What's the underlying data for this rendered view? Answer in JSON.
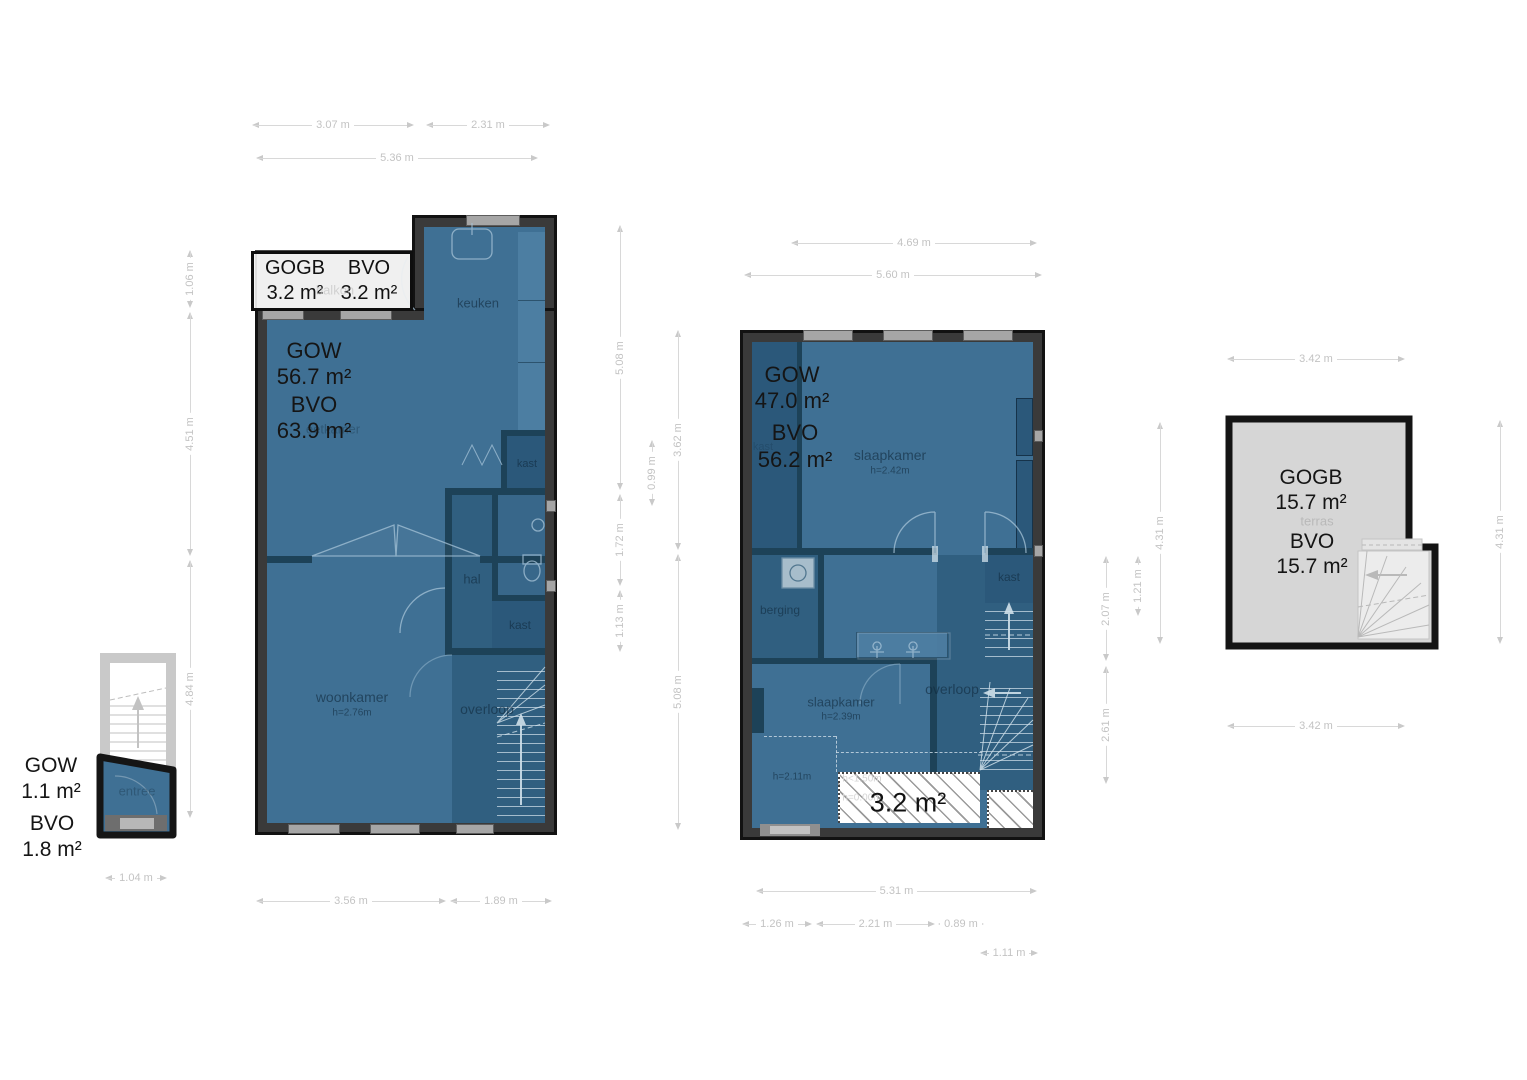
{
  "plans": {
    "floor1": {
      "balkon_box": {
        "col1_title": "GOGB",
        "col1_value": "3.2 m²",
        "col2_title": "BVO",
        "col2_value": "3.2 m²"
      },
      "gow_label": "GOW",
      "gow_value": "56.7 m²",
      "bvo_label": "BVO",
      "bvo_value": "63.9 m²",
      "rooms": {
        "balkon": "balkon",
        "keuken": "keuken",
        "eetkamer": "eetkamer",
        "hal": "hal",
        "kast_a": "kast",
        "kast_b": "kast",
        "woonkamer": "woonkamer",
        "woonkamer_height": "h=2.76m",
        "overloop": "overloop"
      }
    },
    "floor2": {
      "gow_label": "GOW",
      "gow_value": "47.0 m²",
      "bvo_label": "BVO",
      "bvo_value": "56.2 m²",
      "rooms": {
        "kast_left": "kast",
        "slaapkamer1": "slaapkamer",
        "slaapkamer1_height": "h=2.42m",
        "kast_right": "kast",
        "berging": "berging",
        "overloop": "overloop",
        "slaapkamer2": "slaapkamer",
        "slaapkamer2_height": "h=2.39m",
        "zone_height": "h=2.11m",
        "lowzone_a": "h<1.50m",
        "lowzone_b": "h=0.00m",
        "hatch_area": "3.2 m²"
      }
    },
    "roof": {
      "gogb_label": "GOGB",
      "gogb_value": "15.7 m²",
      "bvo_label": "BVO",
      "bvo_value": "15.7 m²",
      "rooms": {
        "terras": "terras"
      }
    },
    "entree": {
      "gow_label": "GOW",
      "gow_value": "1.1 m²",
      "bvo_label": "BVO",
      "bvo_value": "1.8 m²",
      "rooms": {
        "entree": "entree"
      }
    }
  },
  "dimensions": {
    "d_3_07": "3.07 m",
    "d_2_31": "2.31 m",
    "d_5_36": "5.36 m",
    "d_1_06": "1.06 m",
    "d_4_51": "4.51 m",
    "d_4_84": "4.84 m",
    "d_5_08a": "5.08 m",
    "d_1_72": "1.72 m",
    "d_1_13": "1.13 m",
    "d_0_99": "0.99 m",
    "d_3_62": "3.62 m",
    "d_5_08b": "5.08 m",
    "d_4_69": "4.69 m",
    "d_5_60": "5.60 m",
    "d_2_07": "2.07 m",
    "d_2_61": "2.61 m",
    "d_1_21": "1.21 m",
    "d_4_31l": "4.31 m",
    "d_4_31r": "4.31 m",
    "d_3_42t": "3.42 m",
    "d_3_42b": "3.42 m",
    "d_3_56": "3.56 m",
    "d_1_89": "1.89 m",
    "d_5_31": "5.31 m",
    "d_1_26": "1.26 m",
    "d_2_21": "2.21 m",
    "d_0_89": "0.89 m",
    "d_1_11": "1.11 m",
    "d_1_04": "1.04 m"
  },
  "colors": {
    "room_blue": "#3f7094",
    "room_dark": "#305f80",
    "wall": "#3a3a3a",
    "terrace_gray": "#d6d6d6",
    "dim_gray": "#c9c9c9"
  }
}
